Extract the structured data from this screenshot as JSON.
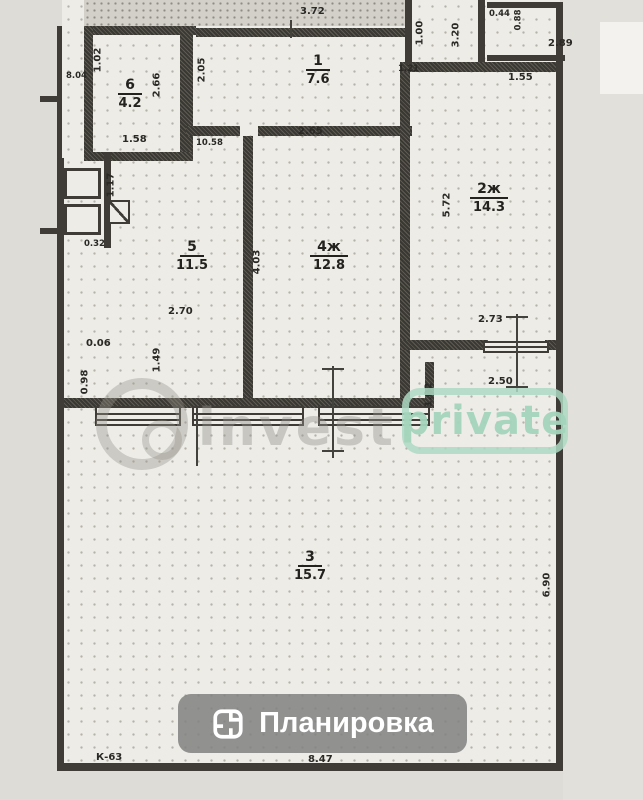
{
  "plan": {
    "rooms": [
      {
        "number": "6",
        "area": "4.2"
      },
      {
        "number": "1",
        "area": "7.6"
      },
      {
        "number": "2ж",
        "area": "14.3"
      },
      {
        "number": "5",
        "area": "11.5"
      },
      {
        "number": "4ж",
        "area": "12.8"
      },
      {
        "number": "3",
        "area": "15.7"
      }
    ],
    "dimensions": {
      "top_372": "3.72",
      "r1_205": "2.05",
      "r1_265": "2.65",
      "r6_102": "1.02",
      "r6_804": "8.04",
      "r6_158": "1.58",
      "r6_266": "2.66",
      "hall_1058": "10.58",
      "tr_100": "1.00",
      "tr_320": "3.20",
      "tr_121": "1.21",
      "tr_044": "0.44",
      "tr_088": "0.88",
      "tr_289": "2.89",
      "tr_155": "1.55",
      "r2_572": "5.72",
      "w_403": "4.03",
      "r5_270": "2.70",
      "sh_117": "1.17",
      "sh_032": "0.32",
      "l_006": "0.06",
      "l_149": "1.49",
      "l_098": "0.98",
      "w_273": "2.73",
      "w_250": "2.50",
      "b_102": "1.02",
      "r3_690": "6.90",
      "bot_847": "8.47",
      "bot_k63": "К-63"
    }
  },
  "watermark": {
    "logo_icon": "camera-swirl-logo",
    "invest": "invest",
    "private": "private"
  },
  "toolbar": {
    "plan_button_label": "Планировка",
    "plan_button_icon": "floorplan-icon"
  },
  "colors": {
    "wall": "#3f3c37",
    "watermark_green": "#a3d4bb",
    "button_bg": "#808080",
    "button_text": "#ffffff"
  }
}
